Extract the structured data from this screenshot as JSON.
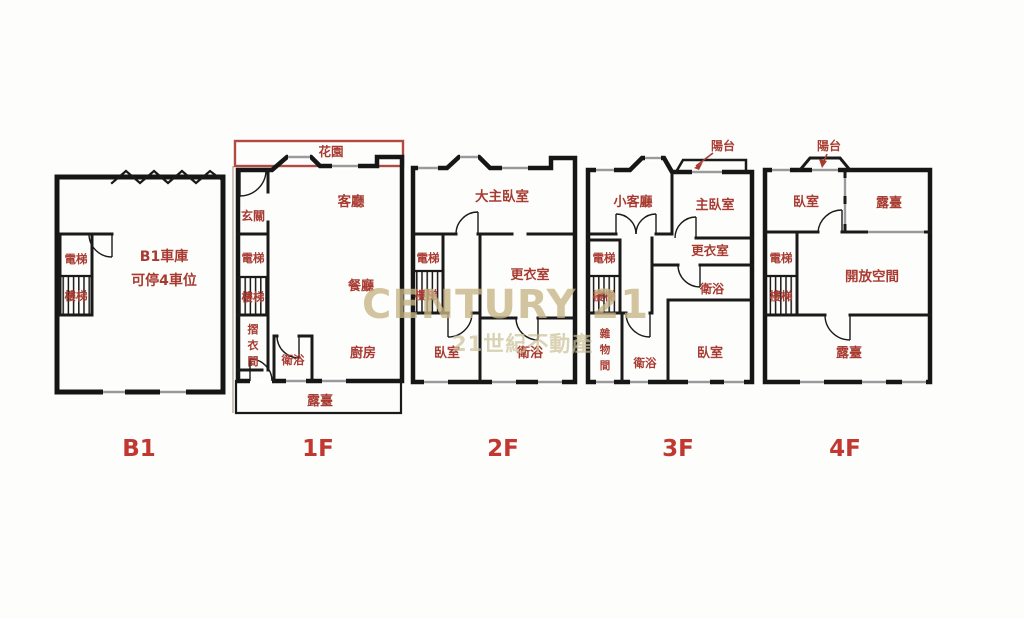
{
  "watermark": {
    "main": "CENTURY 21",
    "sub": "21世紀不動產"
  },
  "colors": {
    "wall": "#161616",
    "room_label": "#a83b31",
    "floor_label": "#c0382f",
    "garden_outline": "#b04a43",
    "watermark": "#c6b586",
    "window": "#9a9a9a"
  },
  "floors": [
    {
      "id": "b1",
      "label": "B1",
      "rooms": {
        "elevator": "電梯",
        "stairs": "樓梯",
        "garage_line1": "B1車庫",
        "garage_line2": "可停4車位"
      }
    },
    {
      "id": "1f",
      "label": "1F",
      "rooms": {
        "garden": "花園",
        "entry": "玄關",
        "living": "客廳",
        "elevator": "電梯",
        "stairs": "樓梯",
        "dining": "餐廳",
        "fold": [
          "摺",
          "衣",
          "間"
        ],
        "bath": "衛浴",
        "kitchen": "廚房",
        "terrace": "露臺"
      }
    },
    {
      "id": "2f",
      "label": "2F",
      "rooms": {
        "master": "大主臥室",
        "elevator": "電梯",
        "stairs": "樓梯",
        "closet": "更衣室",
        "bedroom": "臥室",
        "bath": "衛浴"
      }
    },
    {
      "id": "3f",
      "label": "3F",
      "rooms": {
        "balcony": "陽台",
        "living": "小客廳",
        "master": "主臥室",
        "elevator": "電梯",
        "stairs": "樓梯",
        "closet": "更衣室",
        "bath_upper": "衛浴",
        "storage": [
          "雜",
          "物",
          "間"
        ],
        "bath_lower": "衛浴",
        "bedroom": "臥室"
      }
    },
    {
      "id": "4f",
      "label": "4F",
      "rooms": {
        "balcony": "陽台",
        "bedroom": "臥室",
        "terrace_upper": "露臺",
        "elevator": "電梯",
        "stairs": "樓梯",
        "open_space": "開放空間",
        "terrace_lower": "露臺"
      }
    }
  ]
}
